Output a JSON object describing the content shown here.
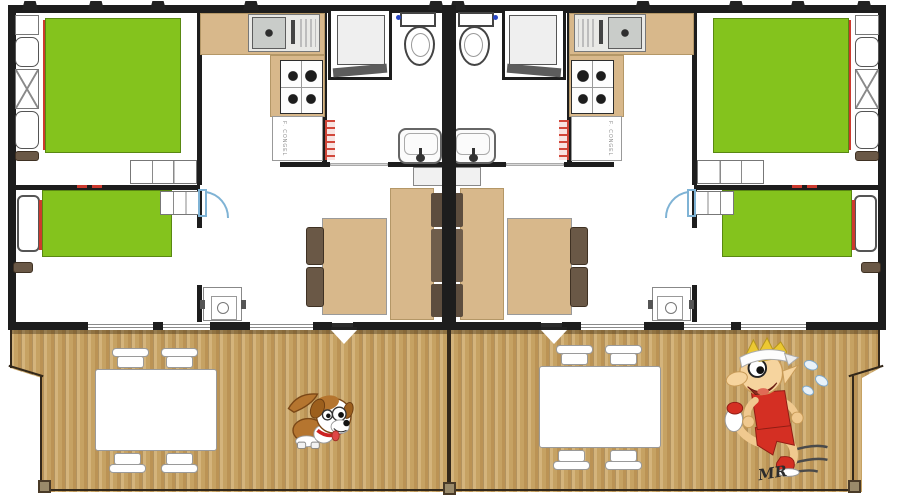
{
  "document": {
    "title": "Mobile home duplex floor plan with wooden terrace",
    "kind": "architectural floor plan, two mirrored units"
  },
  "colors": {
    "bed_green": "#84c31d",
    "counter_tan": "#d8b88b",
    "cushion_dark": "#5d4d3e",
    "deck_wood": "#c6a263",
    "wall_black": "#1d1d1d",
    "accent_red": "#cc3a2e",
    "door_swing_blue": "#7fb3d5",
    "patio_furniture": "#ffffff"
  },
  "units": {
    "count": 2,
    "layout": "mirrored about central party wall",
    "rooms": [
      "double bedroom",
      "single bedroom",
      "kitchen",
      "shower room with toilet",
      "living-dining room"
    ],
    "fixtures": [
      "double bed",
      "single bed",
      "wardrobe shelves",
      "kitchen sink",
      "4-burner hob",
      "fridge-freezer",
      "shower cabin",
      "toilet",
      "washbasin",
      "dining table",
      "two chairs",
      "sofa bench",
      "water heater"
    ]
  },
  "terrace": {
    "decking": "vertical wooden planks",
    "sets": 2,
    "items": [
      "white patio table",
      "four white patio chairs",
      "dog cartoon",
      "running elf cartoon",
      "artist signature"
    ]
  },
  "labels": {
    "fridge": "F. CONGEL",
    "signature": "MR"
  }
}
